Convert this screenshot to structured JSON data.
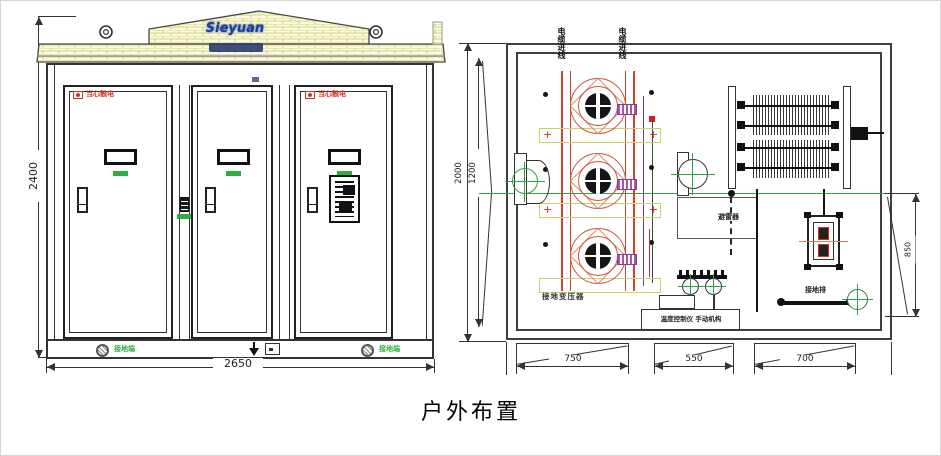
{
  "caption": "户外布置",
  "front_view": {
    "logo_text": "Sieyuan",
    "dim_height": "2400",
    "dim_width": "2650",
    "warning_label": "当心触电",
    "ground_label": "接地端"
  },
  "plan_view": {
    "dim_outer": "2000",
    "dim_inner": "1200",
    "dim_right": "850",
    "dim_bottom": [
      "750",
      "550",
      "700"
    ],
    "label_cable_left": "电缆进线",
    "label_cable_right": "电缆进线",
    "label_transformer": "接地变压器",
    "label_arrester": "避雷器",
    "label_control": "温度控制仪 手动机构",
    "label_ground_bar": "接地排"
  },
  "colors": {
    "warning_red": "#cc3322",
    "ground_green": "#2fae3f",
    "centerline_green": "#2fa045",
    "transformer_red": "#cc5533",
    "bushing_purple": "#8a3a8a",
    "roof_yellow": "#fbfbd8",
    "brand_blue": "#1d3f9e"
  }
}
